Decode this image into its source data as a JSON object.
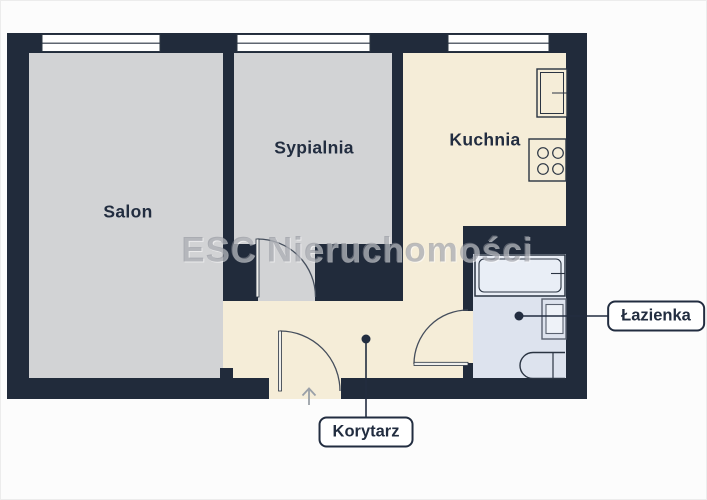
{
  "watermark": {
    "text": "ESC Nieruchomości"
  },
  "rooms": [
    {
      "name": "salon",
      "label": "Salon"
    },
    {
      "name": "sypialnia",
      "label": "Sypialnia"
    },
    {
      "name": "kuchnia",
      "label": "Kuchnia"
    }
  ],
  "callouts": [
    {
      "name": "lazienka",
      "label": "Łazienka"
    },
    {
      "name": "korytarz",
      "label": "Korytarz"
    }
  ],
  "icons": {
    "fixtures": [
      "fridge-icon",
      "stove-icon",
      "bathtub-icon",
      "sink-icon",
      "toilet-icon"
    ],
    "doors": [
      "bedroom-door-arc",
      "bathroom-door-arc",
      "entrance-door-arc"
    ],
    "entrance_arrow_direction": "up",
    "windows_count": 3
  },
  "palette": {
    "wall": "#212b3b",
    "room_gray": "#d2d3d5",
    "kitchen_cream": "#f5edd8",
    "bathroom_blue": "#dde3ee",
    "background": "#fcfcfc",
    "accent_text": "#222d40",
    "arrow_gray": "#9aa0a8"
  }
}
